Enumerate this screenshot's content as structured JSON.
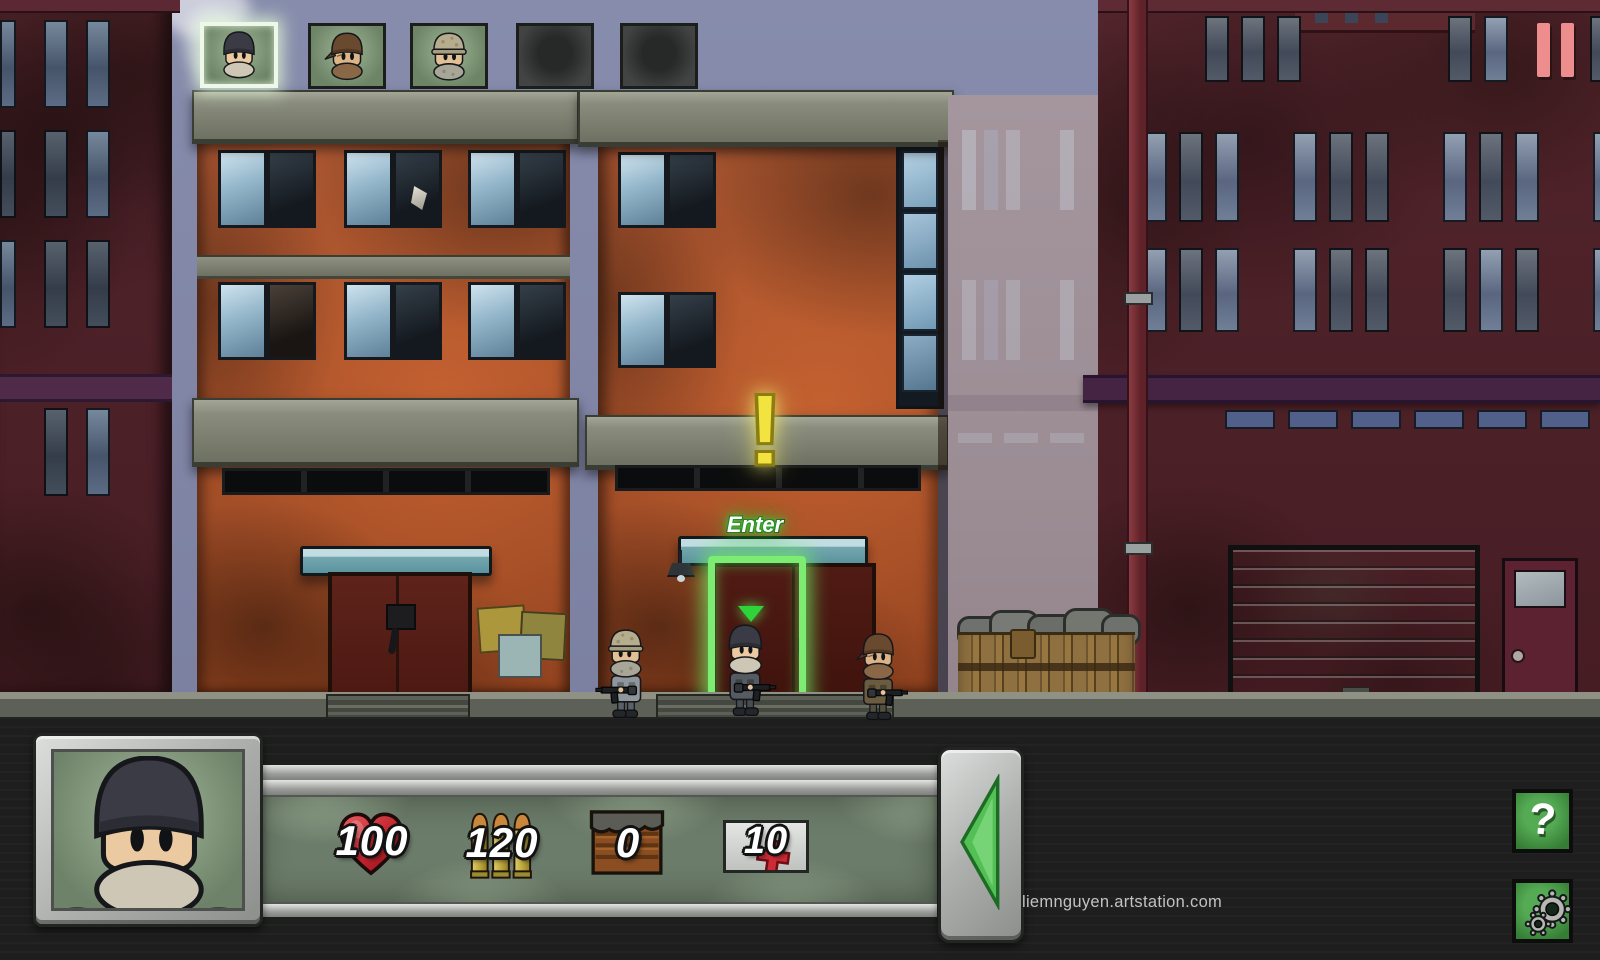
{
  "world": {
    "alert_symbol": "!",
    "enter_label": "Enter"
  },
  "squad_bar": {
    "slots": [
      {
        "portrait": "soldier-beanie",
        "state": "selected"
      },
      {
        "portrait": "soldier-bandana",
        "state": "normal"
      },
      {
        "portrait": "soldier-helmet",
        "state": "normal"
      },
      {
        "portrait": "empty",
        "state": "empty"
      },
      {
        "portrait": "empty",
        "state": "empty"
      }
    ]
  },
  "pause_button": {
    "icon": "pause-icon"
  },
  "hud": {
    "portrait": "soldier-beanie",
    "stats": {
      "health": {
        "icon": "heart-icon",
        "value": "100"
      },
      "ammo": {
        "icon": "bullets-icon",
        "value": "120"
      },
      "crates": {
        "icon": "crate-icon",
        "value": "0"
      },
      "medkits": {
        "icon": "medkit-icon",
        "value": "10"
      }
    },
    "next_button": {
      "icon": "arrow-left-icon"
    },
    "help_button": {
      "label": "?"
    },
    "settings_button": {
      "icon": "gear-icon"
    }
  },
  "footer": {
    "watermark": "liemnguyen.artstation.com"
  },
  "colors": {
    "selection_glow": "#eef8e8",
    "enter_glow": "#35cf3c",
    "alert_yellow": "#f2e340",
    "door_highlight": "#7dec72",
    "pause_red": "#ee8d8d",
    "button_green": "#3e8f3f",
    "arrow_green": "#52c055",
    "health_red": "#c1242d",
    "portrait_bg_green": "#7b9074"
  }
}
